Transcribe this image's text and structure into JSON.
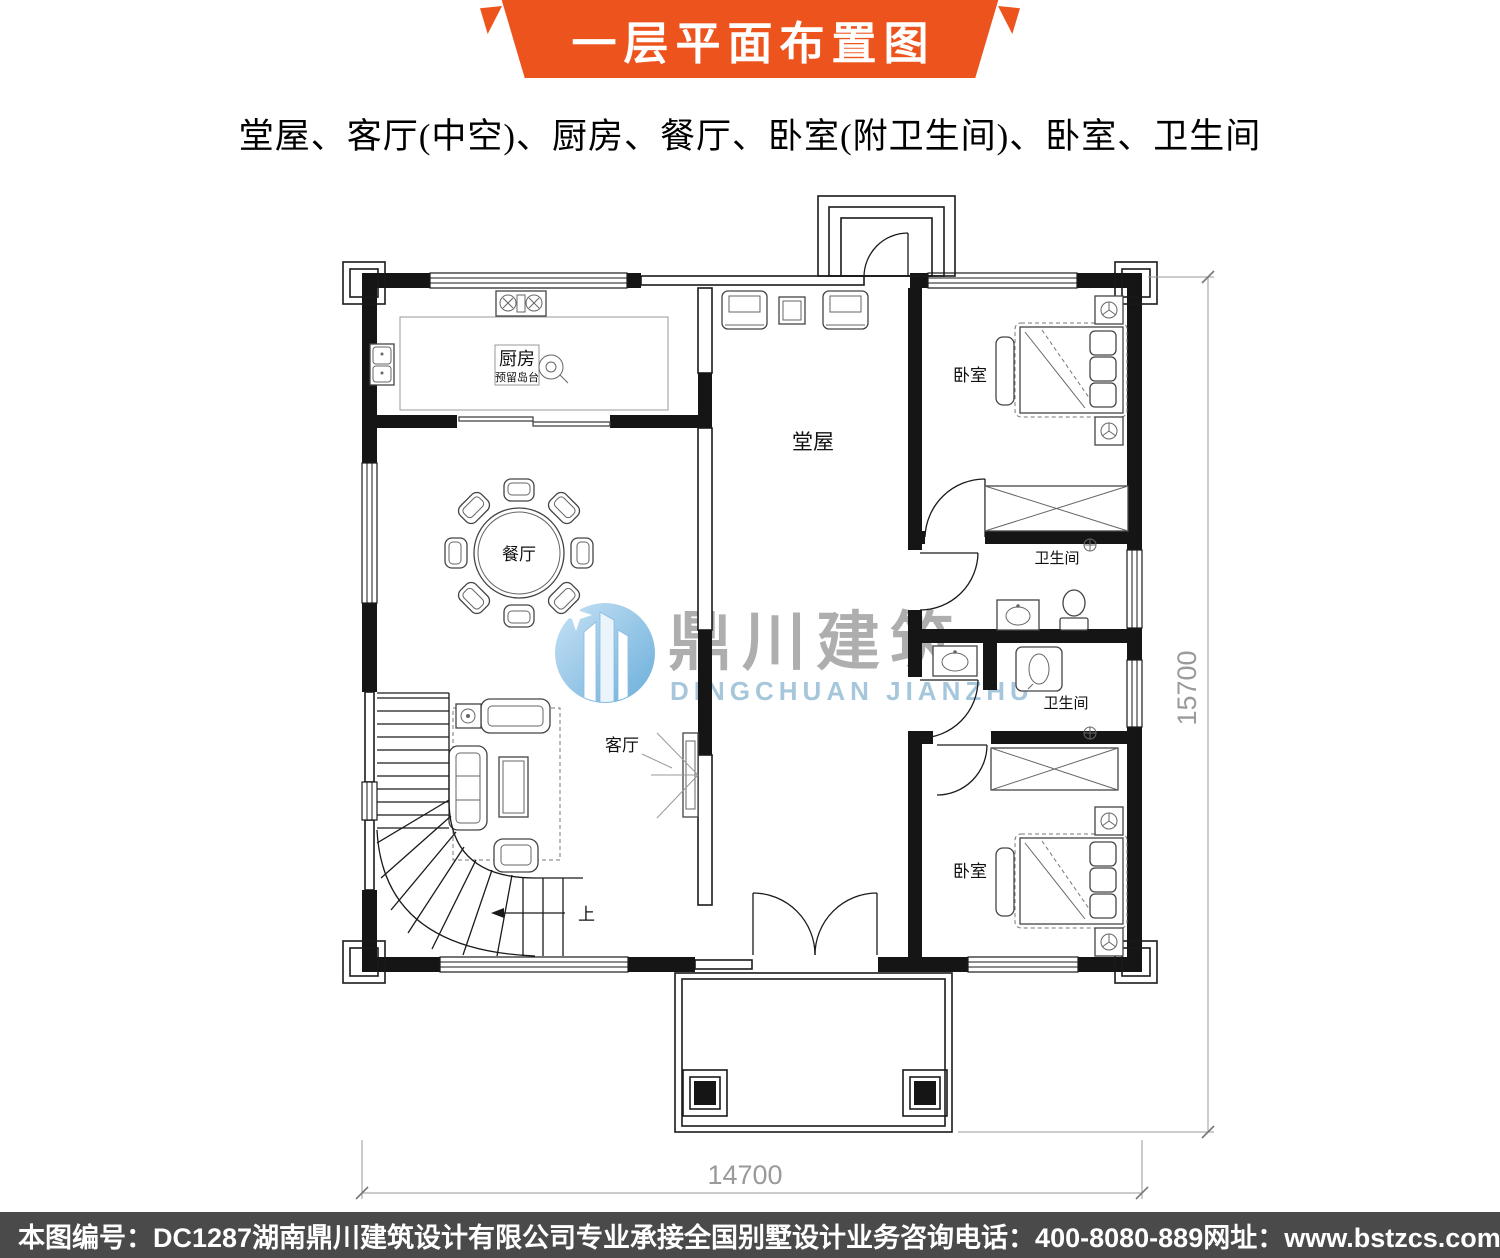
{
  "banner": {
    "title": "一层平面布置图",
    "color": "#ed541d"
  },
  "subtitle": "堂屋、客厅(中空)、厨房、餐厅、卧室(附卫生间)、卧室、卫生间",
  "plan": {
    "room_labels": {
      "hall": "堂屋",
      "kitchen": "厨房",
      "kitchen_note": "预留岛台",
      "dining": "餐厅",
      "living": "客厅",
      "bedroom_top": "卧室",
      "bedroom_bottom": "卧室",
      "bathroom_top": "卫生间",
      "bathroom_bottom": "卫生间",
      "stairs_up": "上"
    },
    "dimensions": {
      "width": "14700",
      "height": "15700"
    }
  },
  "watermark": {
    "cn": "鼎川建筑",
    "en": "DINGCHUAN JIANZHU",
    "blue": "#9fc3d8",
    "gray": "#a8a8a8"
  },
  "footer": {
    "bg": "#4a4a4a",
    "items": [
      "本图编号：DC1287",
      "湖南鼎川建筑设计有限公司专业承接全国别墅设计业务",
      "咨询电话：400-8080-889",
      "网址：www.bstzcs.com"
    ]
  }
}
